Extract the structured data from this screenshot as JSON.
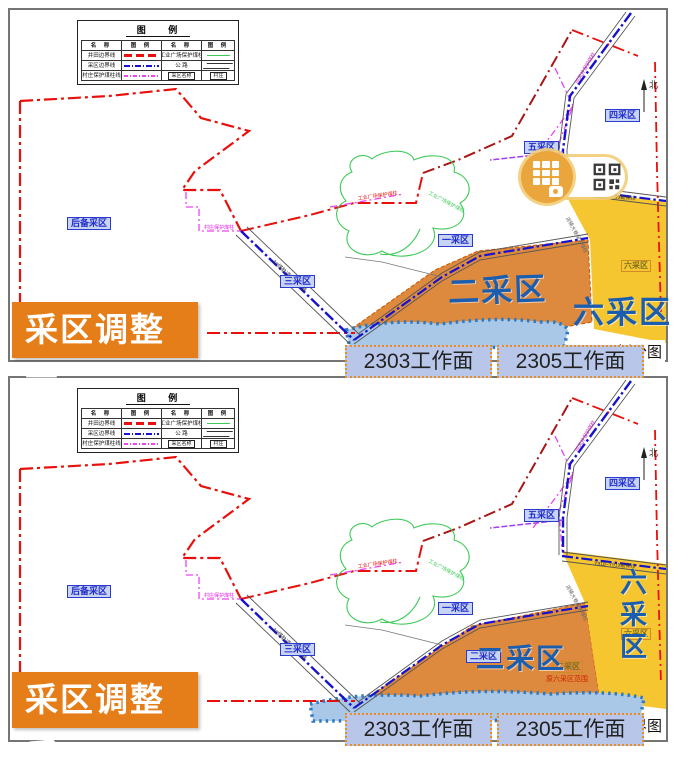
{
  "legend": {
    "title": "图 例",
    "header_name": "名 称",
    "header_sym": "图 例",
    "left_rows": [
      {
        "label": "井田边界线"
      },
      {
        "label": "采区边界线"
      },
      {
        "label": "村庄保护煤柱线"
      }
    ],
    "right_rows": [
      {
        "label": "工业广场保护煤柱"
      },
      {
        "label": "公 路"
      },
      {
        "label": "采区名称",
        "box_label": "村庄"
      }
    ]
  },
  "map_labels": {
    "north": "北",
    "reserve_area": "后备采区",
    "area_one": "一采区",
    "area_two": "二采区",
    "area_three": "三采区",
    "area_four": "四采区",
    "area_five": "五采区",
    "area_six": "六采区",
    "note_after": "原六采区范围"
  },
  "map_annotations": [
    {
      "text": "村庄保护煤柱",
      "x": 194,
      "y": 219,
      "rot": 0,
      "color": "#e020e0",
      "size": 5
    },
    {
      "text": "工业广场保护煤柱",
      "x": 348,
      "y": 190,
      "rot": -8,
      "color": "#e8100c",
      "size": 5
    },
    {
      "text": "3#煤轨道运输大巷",
      "x": 262,
      "y": 252,
      "rot": 43,
      "color": "#333333",
      "size": 5.5
    },
    {
      "text": "Y918~Y919勘探线",
      "x": 584,
      "y": 187,
      "rot": 4,
      "color": "#333333",
      "size": 5
    },
    {
      "text": "运输大巷保护煤柱",
      "x": 556,
      "y": 208,
      "rot": 62,
      "color": "#666666",
      "size": 5
    },
    {
      "text": "回风井保护煤柱",
      "x": 568,
      "y": 74,
      "rot": -60,
      "color": "#cc22cc",
      "size": 5
    },
    {
      "text": "工业广场保护煤柱",
      "x": 418,
      "y": 184,
      "rot": 28,
      "color": "#3ecb5a",
      "size": 5
    }
  ],
  "panels": [
    {
      "badge": "采区调整前",
      "caption": "区划分图",
      "big_two": "二采区",
      "big_six": "六采区",
      "workfaces": [
        "2303工作面",
        "2305工作面"
      ]
    },
    {
      "badge": "采区调整后",
      "caption": "区边界图",
      "big_two": "二采区",
      "big_six": "六采区",
      "workfaces": [
        "2303工作面",
        "2305工作面"
      ]
    }
  ],
  "watermark": {
    "icons": [
      "app-grid-icon",
      "qr-code-icon"
    ]
  },
  "colors": {
    "mine_boundary_red": "#e8100c",
    "area_boundary_blue": "#1612cf",
    "pillar_magenta": "#ee44ee",
    "pillar_green": "#3ecb5a",
    "area_two_fill": "#dd8a3e",
    "area_six_fill": "#f6c630",
    "goaf_strip_fill": "#a9c7e6",
    "badge_orange": "#e57e18",
    "label_blue": "#1f2ccc",
    "big_label_blue": "#1b5eb0"
  }
}
